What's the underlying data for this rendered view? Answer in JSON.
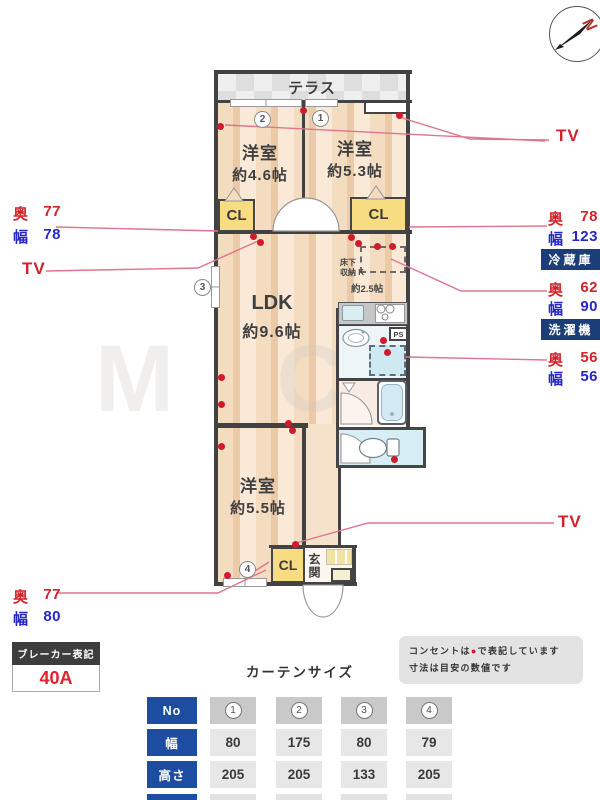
{
  "compass": {
    "north_label": "N"
  },
  "plan": {
    "terrace": "テラス",
    "bedroom_tl": {
      "name": "洋室",
      "size": "約4.6帖"
    },
    "bedroom_tr": {
      "name": "洋室",
      "size": "約5.3帖"
    },
    "ldk": {
      "name": "LDK",
      "size": "約9.6帖"
    },
    "kitchen": {
      "line1": "床下",
      "line2": "収納 K",
      "size": "約2.5帖"
    },
    "bedroom_b": {
      "name": "洋室",
      "size": "約5.5帖"
    },
    "closet_tl": "CL",
    "closet_tr": "CL",
    "closet_b": "CL",
    "entrance": "玄関",
    "ps": "PS",
    "markers": {
      "1": "1",
      "2": "2",
      "3": "3",
      "4": "4"
    }
  },
  "labels": {
    "depth_char": "奥",
    "width_char": "幅",
    "tv": "TV",
    "closet_left": {
      "depth": "77",
      "width": "78"
    },
    "closet_right": {
      "depth": "78",
      "width": "123"
    },
    "fridge": {
      "name": "冷蔵庫",
      "depth": "62",
      "width": "90"
    },
    "washer": {
      "name": "洗濯機",
      "depth": "56",
      "width": "56"
    },
    "closet_bottom": {
      "depth": "77",
      "width": "80"
    }
  },
  "breaker": {
    "title": "ブレーカー表記",
    "value": "40A"
  },
  "note": {
    "line1_before": "コンセントは",
    "line1_symbol": "●",
    "line1_after": "で表記しています",
    "line2": "寸法は目安の数値です"
  },
  "curtain_table": {
    "title": "カーテンサイズ",
    "row_headers": [
      "No",
      "幅",
      "高さ"
    ],
    "columns": [
      "1",
      "2",
      "3",
      "4"
    ],
    "rows": [
      [
        "80",
        "175",
        "80",
        "79"
      ],
      [
        "205",
        "205",
        "133",
        "205"
      ]
    ]
  },
  "watermark": "M C",
  "colors": {
    "accent_red": "#d3222a",
    "accent_blue": "#2727c9",
    "badge_navy": "#1c3e78",
    "table_blue": "#1d4da0",
    "wall": "#424242",
    "outlet_dot": "#cf1b2b"
  }
}
